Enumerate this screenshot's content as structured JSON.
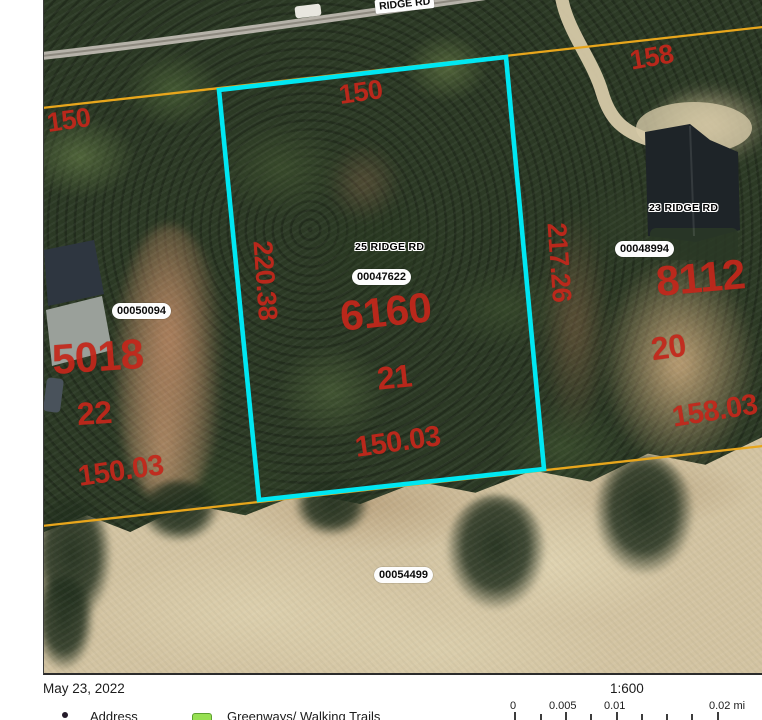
{
  "map": {
    "road_label": "RIDGE RD",
    "address_labels": [
      {
        "text": "25 RIDGE RD"
      },
      {
        "text": "23 RIDGE RD"
      }
    ],
    "parcel_id_badges": [
      {
        "text": "00050094"
      },
      {
        "text": "00047622"
      },
      {
        "text": "00048994"
      },
      {
        "text": "00054499"
      }
    ],
    "red_labels": [
      {
        "text": "150",
        "kind": "frontage-dimension"
      },
      {
        "text": "158",
        "kind": "frontage-dimension"
      },
      {
        "text": "150",
        "kind": "frontage-dimension"
      },
      {
        "text": "220.38",
        "kind": "side-dimension"
      },
      {
        "text": "217.26",
        "kind": "side-dimension"
      },
      {
        "text": "6160",
        "kind": "parcel-area"
      },
      {
        "text": "21",
        "kind": "lot-number"
      },
      {
        "text": "150.03",
        "kind": "rear-dimension"
      },
      {
        "text": "5018",
        "kind": "parcel-area"
      },
      {
        "text": "22",
        "kind": "lot-number"
      },
      {
        "text": "150.03",
        "kind": "rear-dimension"
      },
      {
        "text": "8112",
        "kind": "parcel-area"
      },
      {
        "text": "20",
        "kind": "lot-number"
      },
      {
        "text": "158.03",
        "kind": "rear-dimension"
      }
    ],
    "colors": {
      "annotation_red": "#c4271b",
      "highlight_cyan": "#00e7f2",
      "parcel_line_orange": "#e8a61c"
    }
  },
  "footer": {
    "date": "May 23, 2022",
    "scale_ratio": "1:600",
    "scalebar_labels": [
      "0",
      "0.005",
      "0.01",
      "0.02 mi"
    ],
    "legend": [
      {
        "label": "Address"
      },
      {
        "label": "Greenways/ Walking Trails"
      }
    ]
  }
}
